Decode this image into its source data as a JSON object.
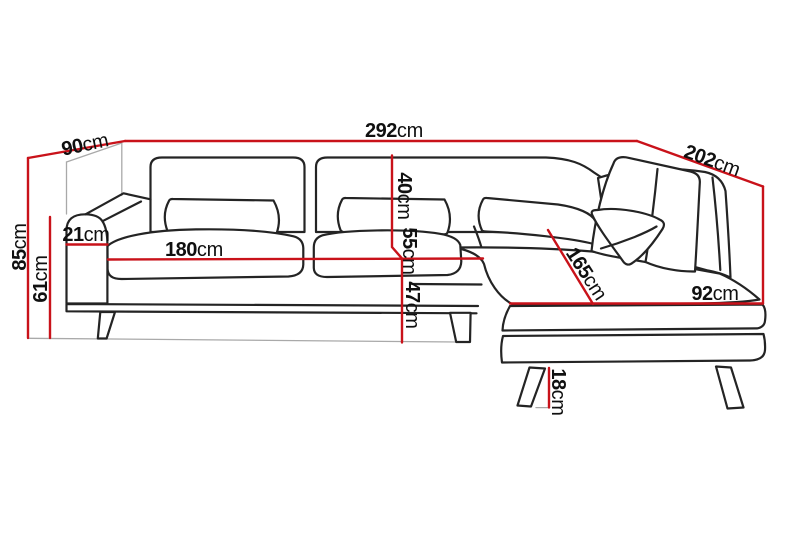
{
  "diagram": {
    "subject": "corner-sofa-dimension-diagram",
    "unit_suffix": "cm",
    "colors": {
      "dimension_line": "#c9121a",
      "outline": "#242424",
      "guide": "#a9a9a9",
      "background": "#ffffff",
      "text": "#101010"
    },
    "dimensions": [
      {
        "name": "total-width",
        "value": "292"
      },
      {
        "name": "depth-left-side",
        "value": "90"
      },
      {
        "name": "right-side-length",
        "value": "202"
      },
      {
        "name": "total-height",
        "value": "85"
      },
      {
        "name": "armrest-height",
        "value": "61"
      },
      {
        "name": "armrest-width",
        "value": "21"
      },
      {
        "name": "seat-width",
        "value": "180"
      },
      {
        "name": "backrest-height",
        "value": "40"
      },
      {
        "name": "seat-depth",
        "value": "55"
      },
      {
        "name": "seat-height",
        "value": "47"
      },
      {
        "name": "chaise-length",
        "value": "165"
      },
      {
        "name": "chaise-width",
        "value": "92"
      },
      {
        "name": "leg-height",
        "value": "18"
      }
    ]
  }
}
